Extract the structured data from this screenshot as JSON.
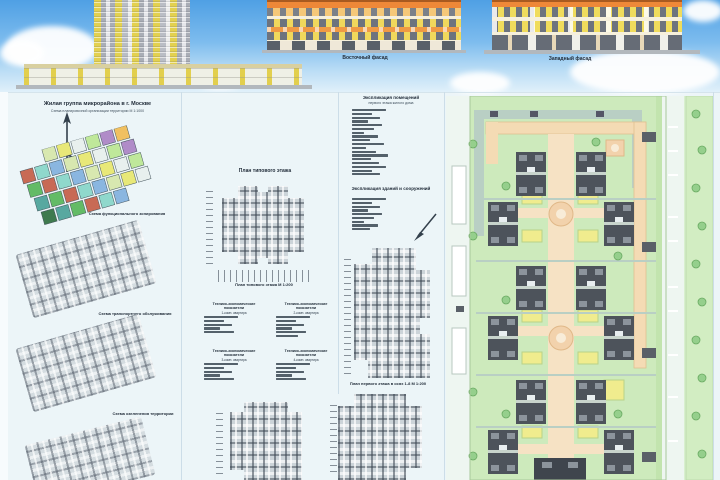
{
  "colors": {
    "sky_top": "#4fa0e4",
    "sky_bottom": "#e2f1fa",
    "board_bg": "#ecf5f8",
    "facade_yellow": "#f0d85c",
    "facade_orange": "#ef9a44",
    "roof_orange": "#ee8838",
    "tower_yellow": "#e3d14f",
    "tower_gray": "#a9adb6",
    "lawn_green": "#cdeabc",
    "road_tan": "#f4dbb4",
    "footprint_gray": "#4d535b",
    "playground_yellow": "#f0ec8e",
    "walkway_gray_green": "#b9cfc4",
    "landuse_palette": [
      "#8fd8cc",
      "#bfe89a",
      "#63bb66",
      "#e8e878",
      "#3f7a4e",
      "#8ab6e0",
      "#b08cc8",
      "#c86a55",
      "#e8f0ee",
      "#58a8a0",
      "#d8e8b0",
      "#f0c060"
    ]
  },
  "elevations": {
    "middle_caption": "Восточный фасад",
    "right_caption": "Западный фасад"
  },
  "left_column": {
    "title": "Жилая группа микрорайона в г. Москве",
    "subtitle": "Схема планировочной организации территории М 1:1000",
    "landuse_caption": "Схема функционального зонирования",
    "transport_caption": "Схема транспортного обслуживания",
    "greenery_caption": "Схема озеленения территории"
  },
  "mid_column": {
    "plan_title": "План типового этажа",
    "plan_caption": "План типового этажа М 1:200",
    "tables": [
      {
        "title": "Технико-экономические показатели",
        "subtitle": "1-комн. квартира"
      },
      {
        "title": "Технико-экономические показатели",
        "subtitle": "2-комн. квартира"
      },
      {
        "title": "Технико-экономические показатели",
        "subtitle": "3-комн. квартира"
      },
      {
        "title": "Технико-экономические показатели",
        "subtitle": "4-комн. квартира"
      }
    ]
  },
  "col3": {
    "legend_title": "Экспликация помещений",
    "legend_subtitle": "первого этажа жилого дома",
    "legend2_title": "Экспликация зданий и сооружений",
    "section_caption": "План первого этажа в осях 1-8  М 1:200"
  }
}
